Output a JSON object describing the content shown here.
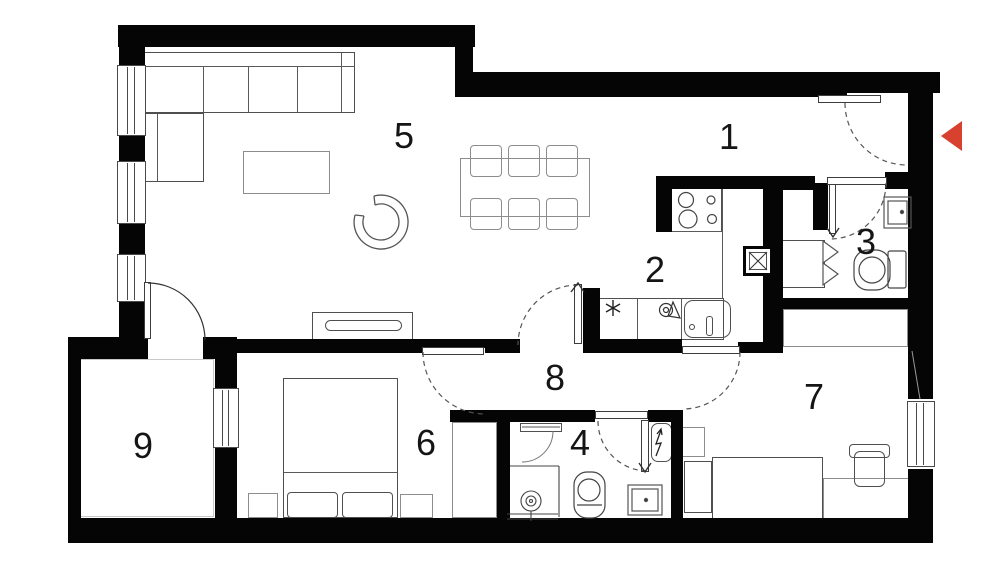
{
  "plan": {
    "type": "apartment-floor-plan",
    "background_color": "#ffffff",
    "wall_color": "#050505",
    "furniture_line_color": "#4f4f4f",
    "entrance_marker_color": "#d8402f"
  },
  "rooms": [
    {
      "number": "1"
    },
    {
      "number": "2"
    },
    {
      "number": "3"
    },
    {
      "number": "4"
    },
    {
      "number": "5"
    },
    {
      "number": "6"
    },
    {
      "number": "7"
    },
    {
      "number": "8"
    },
    {
      "number": "9"
    }
  ]
}
